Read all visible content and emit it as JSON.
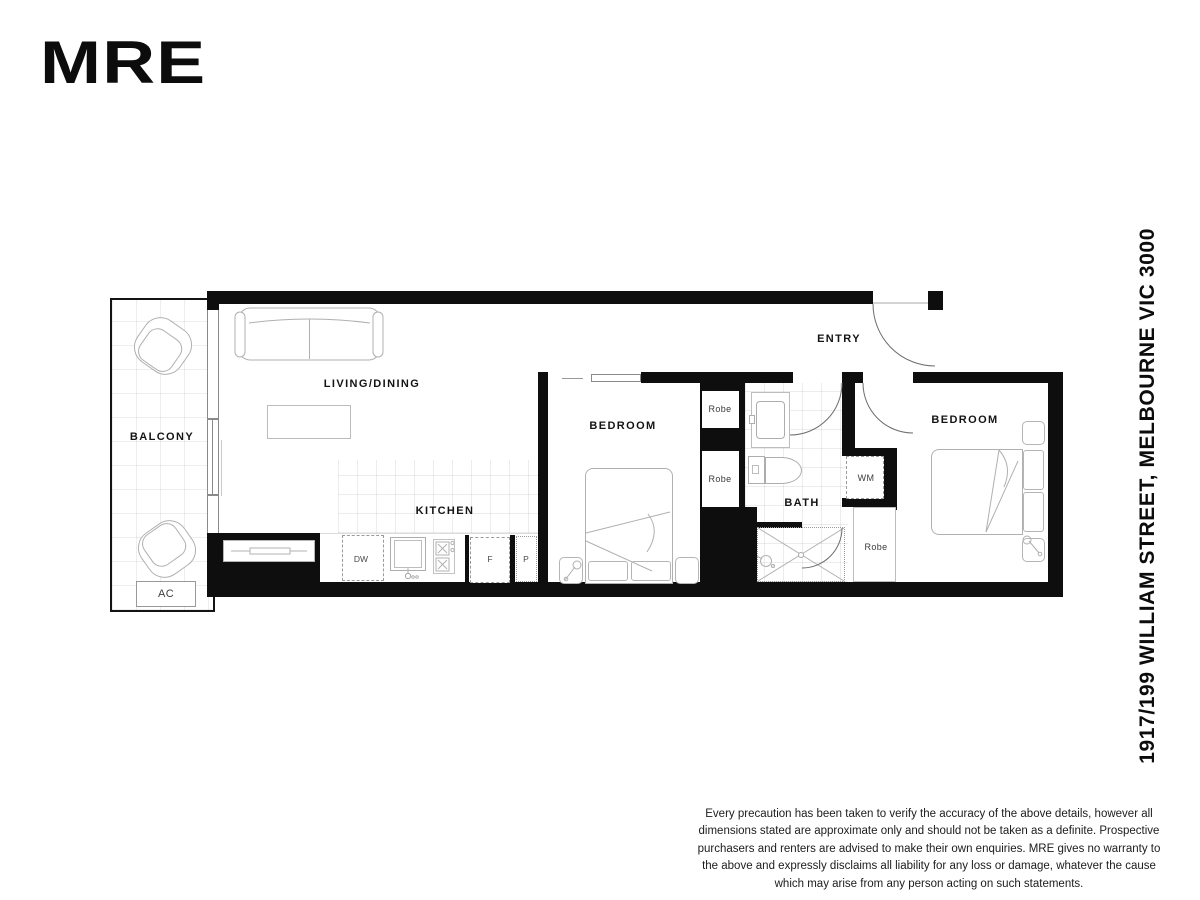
{
  "brand": {
    "logo_text": "MRE"
  },
  "address_vertical": "1917/199 WILLIAM STREET, MELBOURNE VIC 3000",
  "floorplan": {
    "room_labels": {
      "balcony": "BALCONY",
      "living_dining": "LIVING/DINING",
      "kitchen": "KITCHEN",
      "bedroom_1": "BEDROOM",
      "bedroom_2": "BEDROOM",
      "bath": "BATH",
      "entry": "ENTRY"
    },
    "fixture_labels": {
      "robe_1": "Robe",
      "robe_2": "Robe",
      "robe_3": "Robe",
      "washing_machine": "WM",
      "air_conditioner": "AC",
      "dishwasher": "DW",
      "fridge": "F",
      "pantry": "P"
    }
  },
  "disclaimer": "Every precaution has been taken to verify the accuracy of the above details, however all dimensions stated are approximate only and should not be taken as a definite. Prospective purchasers and renters are advised to make their own enquiries. MRE gives no warranty to the above and expressly disclaims all liability for any loss or damage, whatever the cause which may arise from any person acting on such statements."
}
